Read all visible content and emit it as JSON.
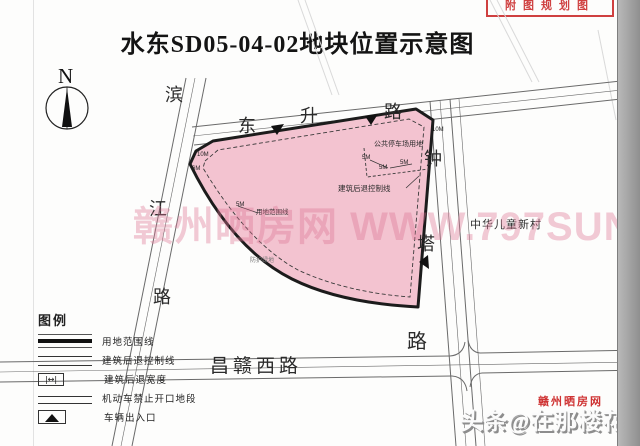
{
  "title": "水东SD05-04-02地块位置示意图",
  "stamp": {
    "text": "附图规划图"
  },
  "north": {
    "label": "N"
  },
  "colors": {
    "plot_fill": "#f3c3d0",
    "plot_outline": "#1c1c1c",
    "road_line": "#6a6a6a",
    "stamp_red": "#cf4040"
  },
  "legend": {
    "title": "图例",
    "items": [
      {
        "label": "用地范围线",
        "symbol": "boundary-thick"
      },
      {
        "label": "建筑后退控制线",
        "symbol": "setback-line"
      },
      {
        "label": "建筑后退宽度",
        "symbol": "setback-width"
      },
      {
        "label": "机动车禁止开口地段",
        "symbol": "no-opening"
      },
      {
        "label": "车辆出入口",
        "symbol": "entrance"
      }
    ]
  },
  "watermarks": {
    "center": "赣州晒房网 WWW.797SUN.COM",
    "bottom_small_red": "赣州晒房网",
    "bottom_big": "头条@在那楼花季节"
  },
  "map": {
    "texts": [
      {
        "name": "north-label",
        "text": "N",
        "x": -999,
        "y": -999,
        "size": 1
      },
      {
        "name": "binjiang-road-char",
        "text": "滨",
        "x": 165,
        "y": 86,
        "size": 18
      },
      {
        "name": "binjiang-road-char",
        "text": "江",
        "x": 149,
        "y": 200,
        "size": 18
      },
      {
        "name": "binjiang-road-char",
        "text": "路",
        "x": 153,
        "y": 288,
        "size": 18
      },
      {
        "name": "dongsheng-road-char",
        "text": "东",
        "x": 238,
        "y": 117,
        "size": 18
      },
      {
        "name": "dongsheng-road-char",
        "text": "升",
        "x": 300,
        "y": 107,
        "size": 18
      },
      {
        "name": "dongsheng-road-char",
        "text": "路",
        "x": 384,
        "y": 103,
        "size": 18
      },
      {
        "name": "zhongta-road-char",
        "text": "钟",
        "x": 424,
        "y": 150,
        "size": 18
      },
      {
        "name": "zhongta-road-char",
        "text": "塔",
        "x": 417,
        "y": 235,
        "size": 18
      },
      {
        "name": "zhongta-road-char",
        "text": "路",
        "x": 407,
        "y": 332,
        "size": 20
      },
      {
        "name": "changgan-west-road-label",
        "text": "昌赣西路",
        "x": 210,
        "y": 357,
        "size": 19,
        "spacing": 4
      },
      {
        "name": "neighborhood-label",
        "text": "中华儿童新村",
        "x": 470,
        "y": 220,
        "size": 11,
        "spacing": 1
      },
      {
        "name": "parking-area-label",
        "text": "公共停车场用地",
        "x": 374,
        "y": 141,
        "size": 7
      },
      {
        "name": "setback-control-line-label",
        "text": "建筑后退控制线",
        "x": 338,
        "y": 185,
        "size": 7.5
      },
      {
        "name": "boundary-line-label",
        "text": "用地范围线",
        "x": 256,
        "y": 210,
        "size": 6.5
      },
      {
        "name": "green-buffer-label",
        "text": "防护绿地",
        "x": 250,
        "y": 258,
        "size": 6,
        "color": "#777777"
      },
      {
        "name": "dimension-label",
        "cls": "dim",
        "text": "10M",
        "x": 197,
        "y": 152,
        "size": 6
      },
      {
        "name": "dimension-label",
        "cls": "dim",
        "text": "6M",
        "x": 192,
        "y": 166,
        "size": 6
      },
      {
        "name": "dimension-label",
        "cls": "dim",
        "text": "5M",
        "x": 236,
        "y": 202,
        "size": 6
      },
      {
        "name": "dimension-label",
        "cls": "dim",
        "text": "10M",
        "x": 432,
        "y": 127,
        "size": 6
      },
      {
        "name": "dimension-label",
        "cls": "dim",
        "text": "5M",
        "x": 362,
        "y": 155,
        "size": 6
      },
      {
        "name": "dimension-label",
        "cls": "dim",
        "text": "5M",
        "x": 379,
        "y": 165,
        "size": 6
      },
      {
        "name": "dimension-label",
        "cls": "dim",
        "text": "5M",
        "x": 400,
        "y": 160,
        "size": 6
      }
    ]
  }
}
